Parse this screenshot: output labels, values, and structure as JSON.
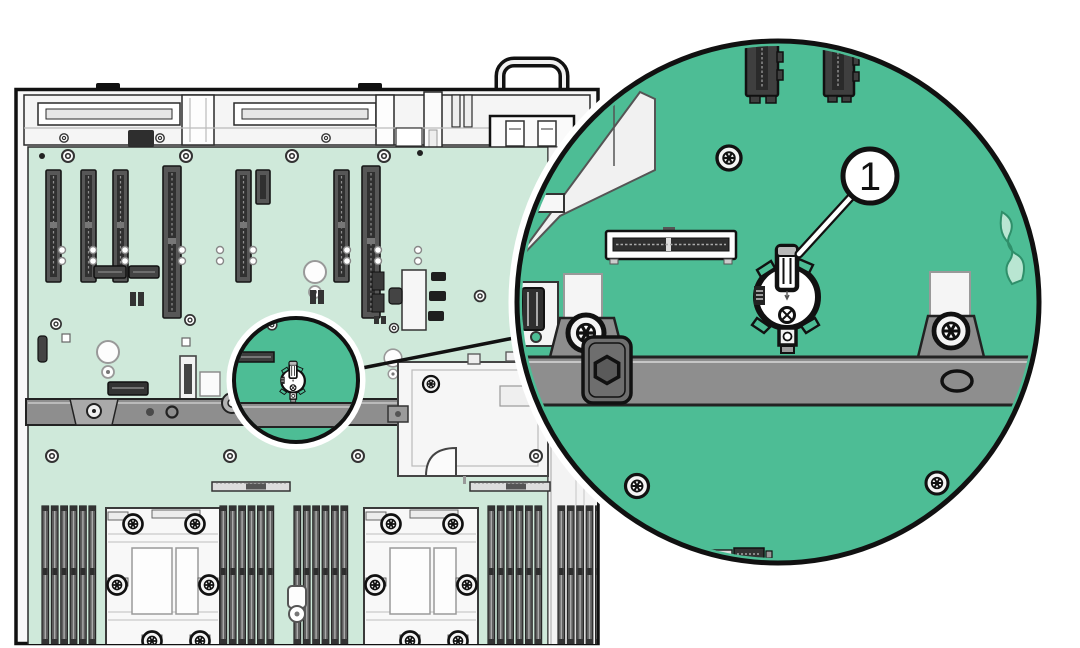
{
  "callout": {
    "number": "1"
  },
  "colors": {
    "board_green": "#cfe9da",
    "highlight_green": "#4dbd95",
    "bar_gray": "#8e8e8e",
    "latch_gray": "#6e6e6e",
    "chassis_white": "#f8f8f8",
    "slot_dark": "#575757",
    "outline_black": "#1a1a1a",
    "background": "#ffffff"
  },
  "icons": {
    "magnifier_circle": "battery-location-highlight",
    "callout_circle": "callout-1"
  }
}
